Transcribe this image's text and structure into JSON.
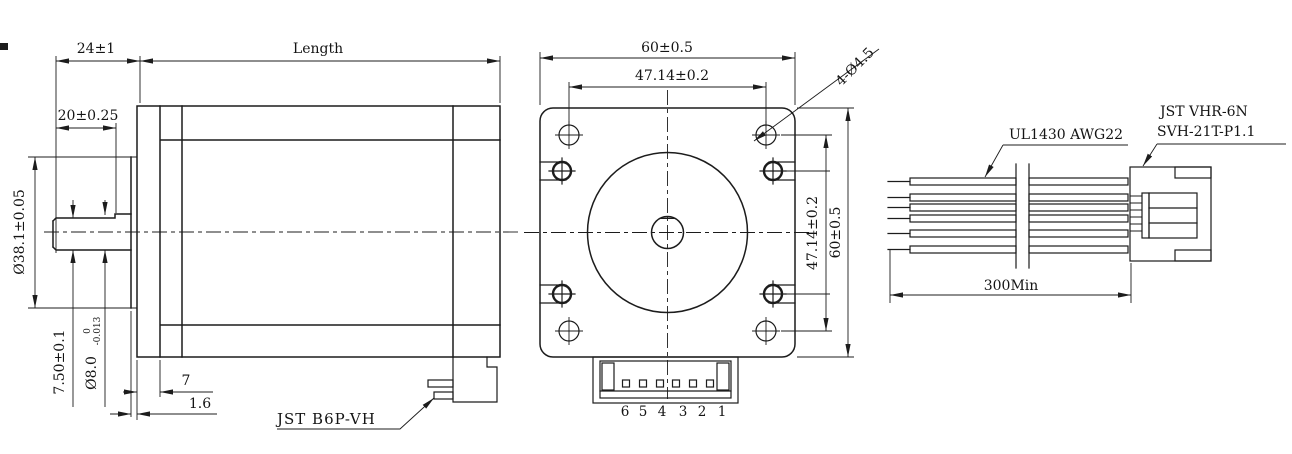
{
  "side_view": {
    "shaft_extension_dim": "24±1",
    "body_length_dim": "Length",
    "shaft_flat_length_dim": "20±0.25",
    "pilot_diameter_dim": "Ø38.1±0.05",
    "shaft_flat_height_dim": "7.50±0.1",
    "shaft_diameter_dim": "Ø8.0",
    "shaft_diameter_tol_upper": "0",
    "shaft_diameter_tol_lower": "-0.013",
    "flange_thickness_dim": "7",
    "pilot_depth_dim": "1.6",
    "connector_label": "JST B6P-VH"
  },
  "front_view": {
    "width_dim": "60±0.5",
    "hole_spacing_horizontal_dim": "47.14±0.2",
    "mounting_holes_label": "4-Ø4.5",
    "hole_spacing_vertical_dim": "47.14±0.2",
    "height_dim": "60±0.5",
    "pin_numbers": [
      "6",
      "5",
      "4",
      "3",
      "2",
      "1"
    ]
  },
  "cable_view": {
    "wire_spec_label": "UL1430 AWG22",
    "connector_label_line1": "JST VHR-6N",
    "connector_label_line2": "SVH-21T-P1.1",
    "cable_length_dim": "300Min"
  },
  "colors": {
    "line_color": "#1c1c1c",
    "background": "#ffffff"
  }
}
